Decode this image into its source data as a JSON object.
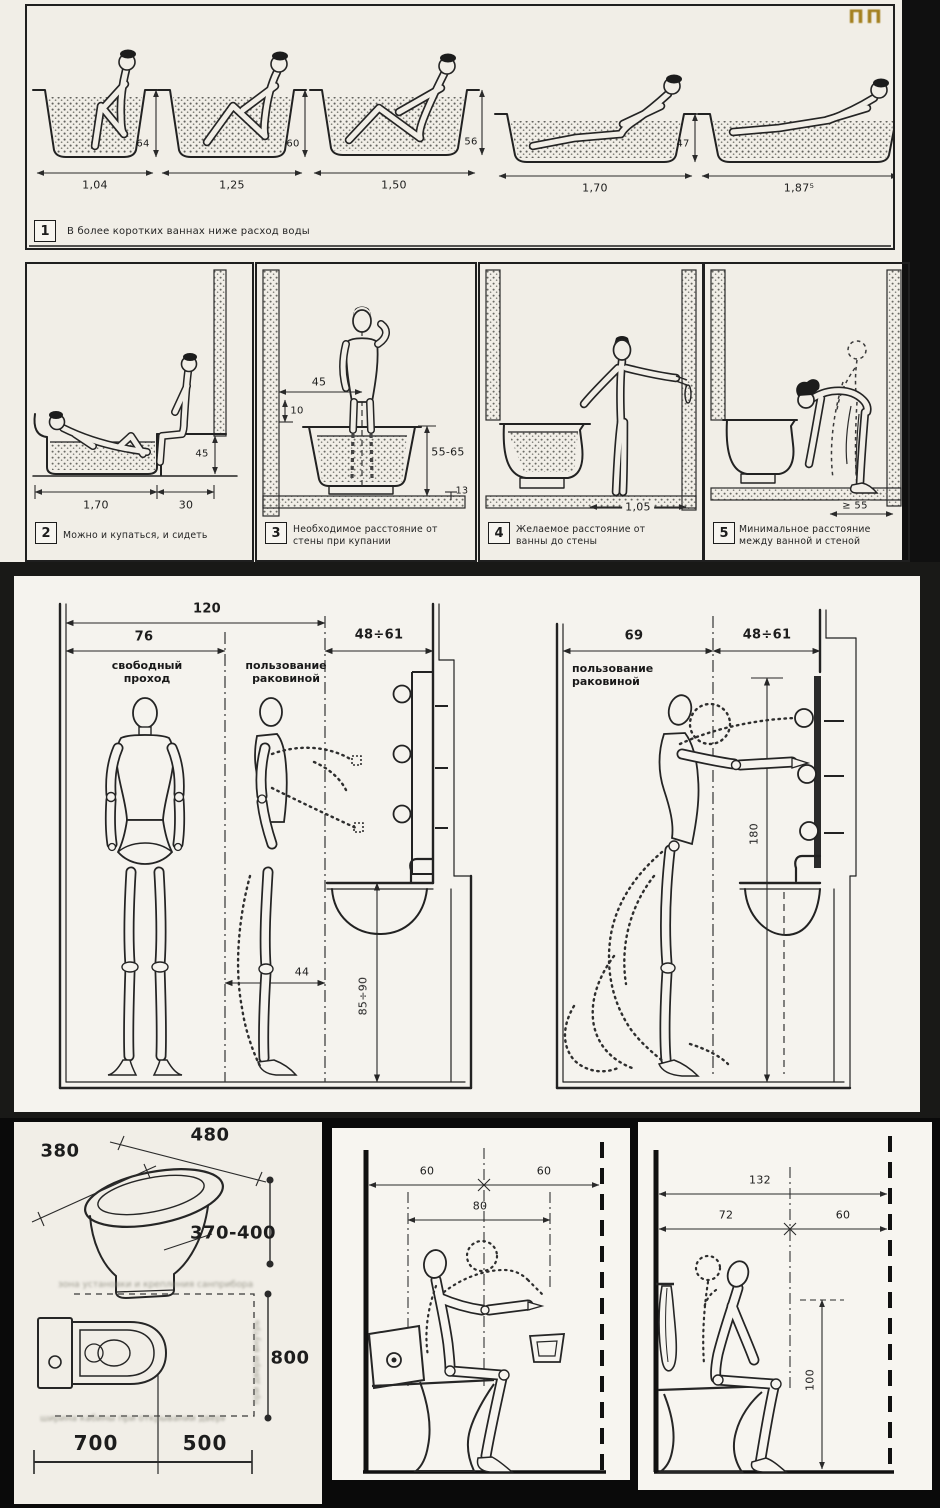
{
  "meta": {
    "logo": "ПП"
  },
  "p1": {
    "num": "1",
    "caption": "В более коротких ваннах ниже расход воды",
    "len": [
      "1,04",
      "1,25",
      "1,50",
      "1,70",
      "1,87⁵"
    ],
    "ht": [
      "64",
      "60",
      "56",
      "47"
    ]
  },
  "p2": {
    "num": "2",
    "caption": "Можно и купаться, и сидеть",
    "len": "1,70",
    "seat": "30",
    "h": "45"
  },
  "p3": {
    "num": "3",
    "caption": "Необходимое расстояние от стены при купании",
    "a": "45",
    "b": "10",
    "h": "55-65",
    "f": "13"
  },
  "p4": {
    "num": "4",
    "caption": "Желаемое расстояние от ванны до стены",
    "a": "1,05"
  },
  "p5": {
    "num": "5",
    "caption": "Минимальное расстояние между ванной и стеной",
    "a": "≥ 55"
  },
  "sink_left": {
    "total": "120",
    "pass": "76",
    "zone": "48÷61",
    "pass_label": "свободный проход",
    "use_label": "пользование раковиной",
    "d44": "44",
    "h": "85÷90"
  },
  "sink_right": {
    "use": "69",
    "zone": "48÷61",
    "label": "пользование раковиной",
    "h": "180"
  },
  "wc_plan": {
    "w1": "380",
    "w2": "480",
    "h": "370-400",
    "depth": "800",
    "a": "700",
    "b": "500",
    "illegible_top": "зона установки и крепления санприбора",
    "illegible_bottom": "ширина кабины при открывании двери наружу",
    "illegible_side": "при двери внутрь"
  },
  "wc_side1": {
    "a": "60",
    "b": "60",
    "c": "80"
  },
  "wc_side2": {
    "total": "132",
    "a": "72",
    "b": "60",
    "h": "100"
  }
}
